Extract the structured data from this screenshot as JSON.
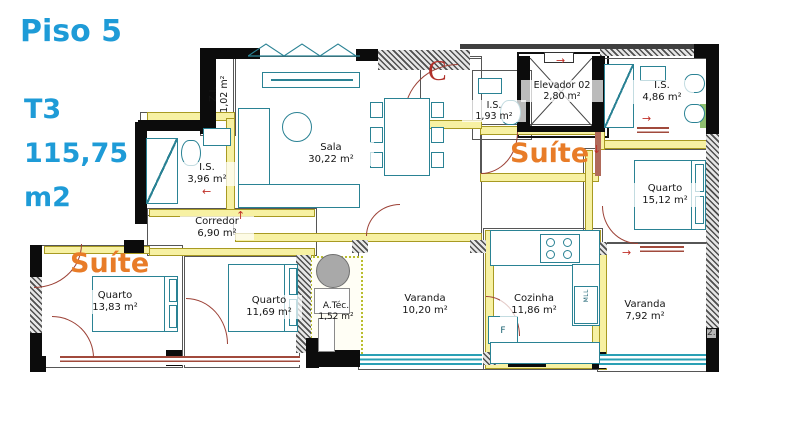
{
  "header": {
    "floor": "Piso 5",
    "typology": "T3",
    "total_area": "115,75",
    "area_unit": "m2"
  },
  "rooms": {
    "sala": {
      "name": "Sala",
      "area": "30,22 m²"
    },
    "zi": {
      "name": "Z.I.",
      "area": "1,02 m²"
    },
    "is_hall": {
      "name": "I.S.",
      "area": "1,93 m²"
    },
    "elevador": {
      "name": "Elevador 02",
      "area": "2,80 m²"
    },
    "is_suite2": {
      "name": "I.S.",
      "area": "4,86 m²"
    },
    "quarto_suite2": {
      "name": "Quarto",
      "area": "15,12 m²"
    },
    "is_suite1": {
      "name": "I.S.",
      "area": "3,96 m²"
    },
    "corredor": {
      "name": "Corredor",
      "area": "6,90 m²"
    },
    "quarto_suite1": {
      "name": "Quarto",
      "area": "13,83 m²"
    },
    "quarto_mid": {
      "name": "Quarto",
      "area": "11,69 m²"
    },
    "atec": {
      "name": "A.Téc.",
      "area": "1,52 m²"
    },
    "varanda1": {
      "name": "Varanda",
      "area": "10,20 m²"
    },
    "cozinha": {
      "name": "Cozinha",
      "area": "11,86 m²"
    },
    "varanda2": {
      "name": "Varanda",
      "area": "7,92 m²"
    }
  },
  "labels": {
    "suite_left": "Suíte",
    "suite_right": "Suíte",
    "entrance": "C",
    "fridge": "F",
    "dishwasher": "MLL",
    "dim_fragment": "2.",
    "arrow_up": "↑",
    "arrow_left": "←",
    "arrow_down": "↓",
    "arrow_right": "→"
  },
  "colors": {
    "accent_blue": "#1e9bd7",
    "suite_orange": "#e87c28",
    "entrance_red": "#b0302a",
    "furniture_teal": "#2a8294",
    "wall_yellow": "#f7f1a3",
    "door_brown": "#9c4136"
  }
}
